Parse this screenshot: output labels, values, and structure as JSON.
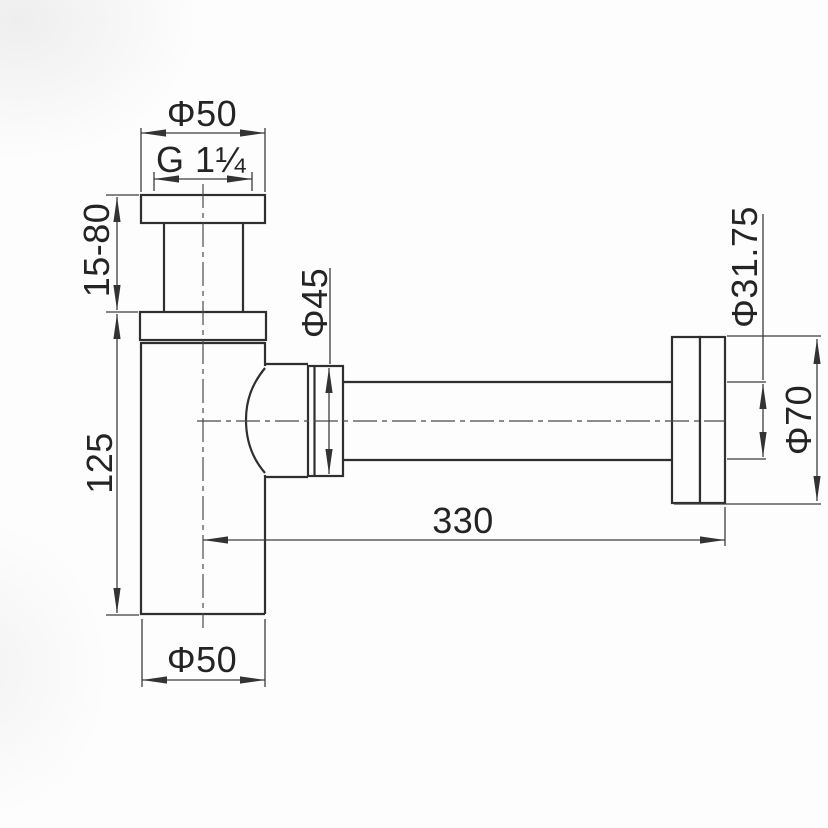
{
  "drawing": {
    "type": "technical-dimension-drawing",
    "subject": "bottle trap siphon with wall outlet pipe",
    "labels": {
      "top_diameter": "Φ50",
      "thread_size": "G 1¼",
      "inlet_adjust_range": "15-80",
      "body_height": "125",
      "nut_diameter": "Φ45",
      "pipe_diameter": "Φ31.75",
      "escutcheon_diameter": "Φ70",
      "pipe_length": "330",
      "bottom_diameter": "Φ50"
    },
    "colors": {
      "object_line": "#2f2f2f",
      "dimension_line": "#3c3c3c",
      "text": "#242424",
      "background": "#fdfdfd"
    }
  }
}
